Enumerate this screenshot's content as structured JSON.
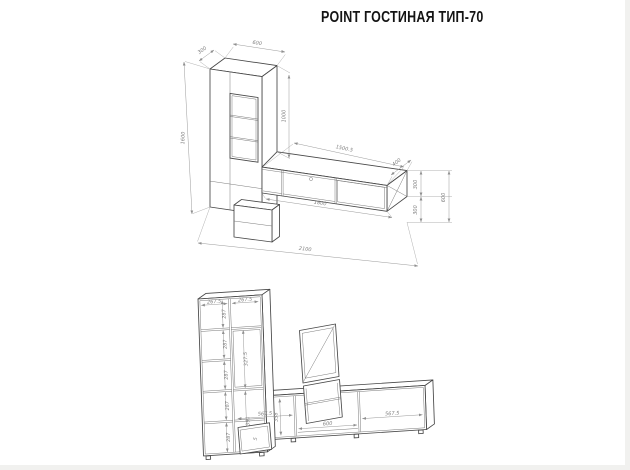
{
  "title": "POINT ГОСТИНАЯ ТИП-70",
  "colors": {
    "line": "#474747",
    "dim": "#8f8f8f",
    "background": "#ffffff"
  },
  "iso_view": {
    "depth_top": "300",
    "width_top": "600",
    "height_left": "1600",
    "gap_right": "1000",
    "top_length": "1500.5",
    "end_depth": "400",
    "end_upper": "300",
    "end_lower": "300",
    "end_total": "600",
    "bottom_length": "1800",
    "overall_width": "2100"
  },
  "front_view": {
    "col_left_width": "267.5",
    "col_right_width": "267.5",
    "left_shelves": [
      "287",
      "287",
      "287",
      "287",
      "287"
    ],
    "right_upper": "327.5",
    "right_lower": "391",
    "tv_left": "567.5",
    "tv_middle": "600",
    "tv_right": "567.5",
    "tv_height": "358",
    "base_box": "5"
  }
}
